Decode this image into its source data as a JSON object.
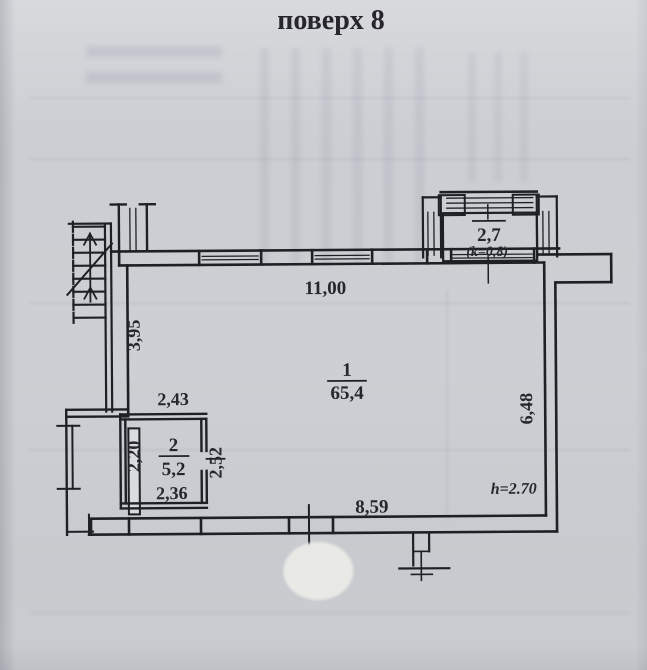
{
  "photo": {
    "title": "поверх 8"
  },
  "plan": {
    "room_main": {
      "number": "1",
      "area": "65,4"
    },
    "room_2": {
      "number": "2",
      "area": "5,2"
    },
    "balcony": {
      "area": "2,7",
      "coef": "(k=0,8)"
    },
    "dims": {
      "top_wall": "11,00",
      "stair_wall": "3,95",
      "right_wall": "6,48",
      "bottom_wall": "8,59",
      "ceiling_height": "h=2.70",
      "room2_top": "2,43",
      "room2_left": "2,20",
      "room2_bottom": "2,36",
      "room2_right": "2,52"
    }
  }
}
